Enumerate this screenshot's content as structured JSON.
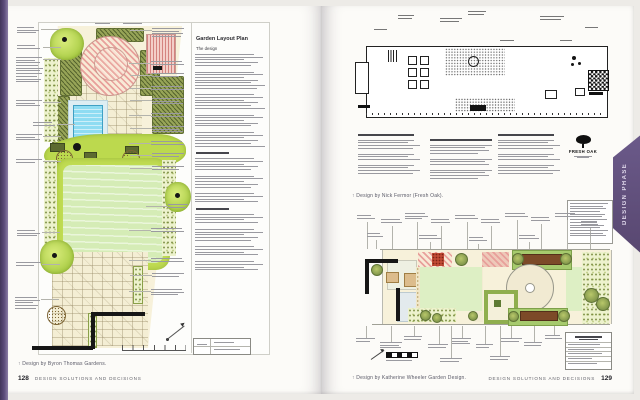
{
  "book": {
    "side_tab": "DESIGN PHASE",
    "left_page": {
      "text_panel": {
        "title": "Garden Layout Plan",
        "subhead": "The design"
      },
      "caption": "↑ Design by Byron Thomas Gardens.",
      "footer": {
        "page_number": "128",
        "title": "DESIGN SOLUTIONS AND DECISIONS"
      }
    },
    "right_page": {
      "top_plan_caption": "↑ Design by Nick Fermor (Fresh Oak).",
      "fresh_oak_logo": "FRESH OAK",
      "bottom_plan_caption": "↑ Design by Katherine Wheeler Garden Design.",
      "footer": {
        "title": "DESIGN SOLUTIONS AND DECISIONS",
        "page_number": "129"
      }
    }
  },
  "colors": {
    "tab_purple": "#5d4b78",
    "spine_purple": "#54456e",
    "lawn_green": "#cfe9ad",
    "pool_blue": "#8edcf2",
    "planting_olive": "#8a9a4e",
    "paving_cream": "#f5efd6",
    "accent_pink": "#eba9a4"
  }
}
